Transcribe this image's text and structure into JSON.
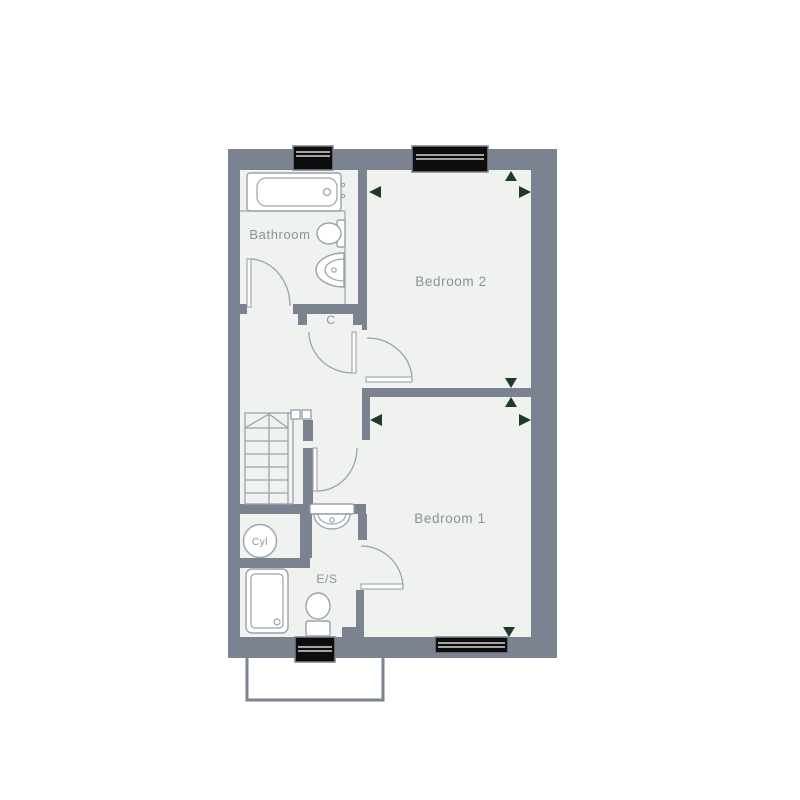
{
  "floorplan": {
    "rooms": {
      "bathroom": {
        "label": "Bathroom"
      },
      "bedroom2": {
        "label": "Bedroom 2"
      },
      "bedroom1": {
        "label": "Bedroom 1"
      },
      "cupboard": {
        "label": "C"
      },
      "cylinder": {
        "label": "Cyl"
      },
      "ensuite": {
        "label": "E/S"
      }
    },
    "colors": {
      "wall": "#7b8290",
      "floor": "#f0f2ef",
      "window_glazing": "#0d0d0d",
      "dimension_marker": "#1e3a2a",
      "fixture_line": "#9aa2ab",
      "label_text": "#8b9199",
      "background": "#ffffff"
    }
  }
}
